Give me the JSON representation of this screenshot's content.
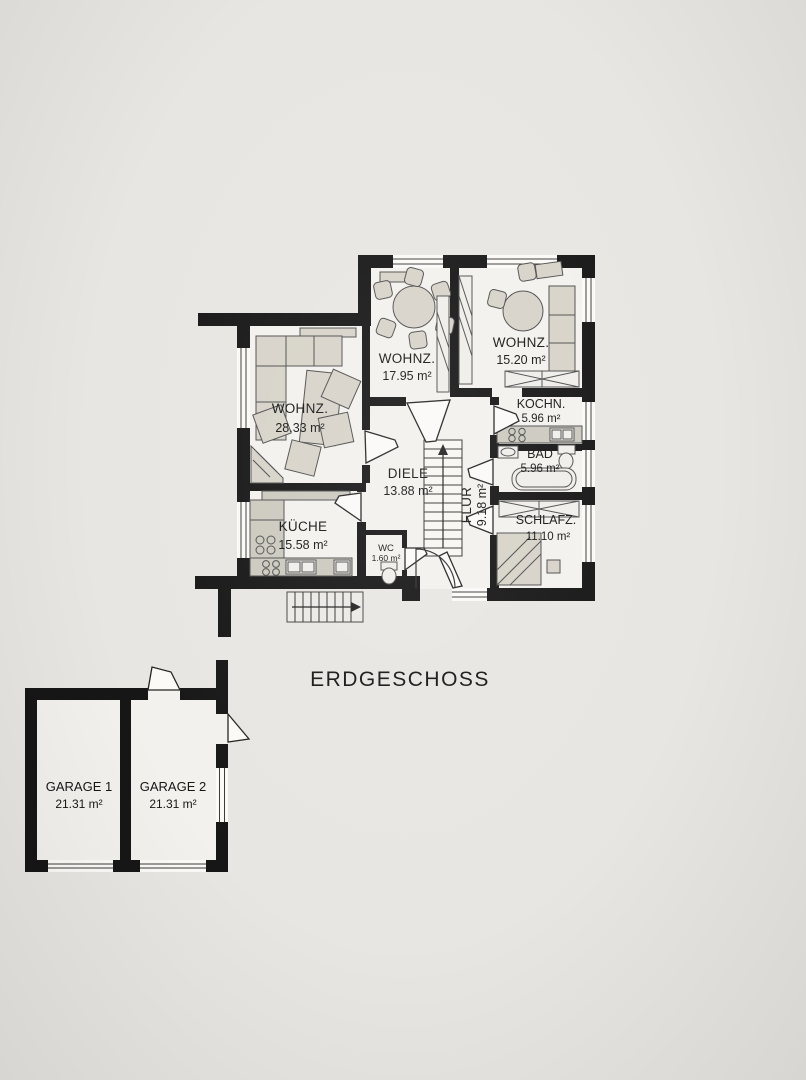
{
  "title": "ERDGESCHOSS",
  "rooms": {
    "wohnz_left": {
      "name": "WOHNZ.",
      "area": "28.33 m²"
    },
    "wohnz_mid": {
      "name": "WOHNZ.",
      "area": "17.95 m²"
    },
    "wohnz_right": {
      "name": "WOHNZ.",
      "area": "15.20 m²"
    },
    "kochn": {
      "name": "KOCHN.",
      "area": "5.96 m²"
    },
    "bad": {
      "name": "BAD",
      "area": "5.96 m²"
    },
    "diele": {
      "name": "DIELE",
      "area": "13.88 m²"
    },
    "flur": {
      "name": "FLUR",
      "area": "9.18 m²"
    },
    "kueche": {
      "name": "KÜCHE",
      "area": "15.58 m²"
    },
    "wc": {
      "name": "WC",
      "area": "1.60 m²"
    },
    "schlafz": {
      "name": "SCHLAFZ.",
      "area": "11.10 m²"
    },
    "garage1": {
      "name": "GARAGE 1",
      "area": "21.31 m²"
    },
    "garage2": {
      "name": "GARAGE 2",
      "area": "21.31 m²"
    }
  },
  "colors": {
    "paper": "#e8e6e2",
    "wall": "#161616",
    "floor": "#f3f1ed",
    "furniture": "#d7d3c9"
  }
}
